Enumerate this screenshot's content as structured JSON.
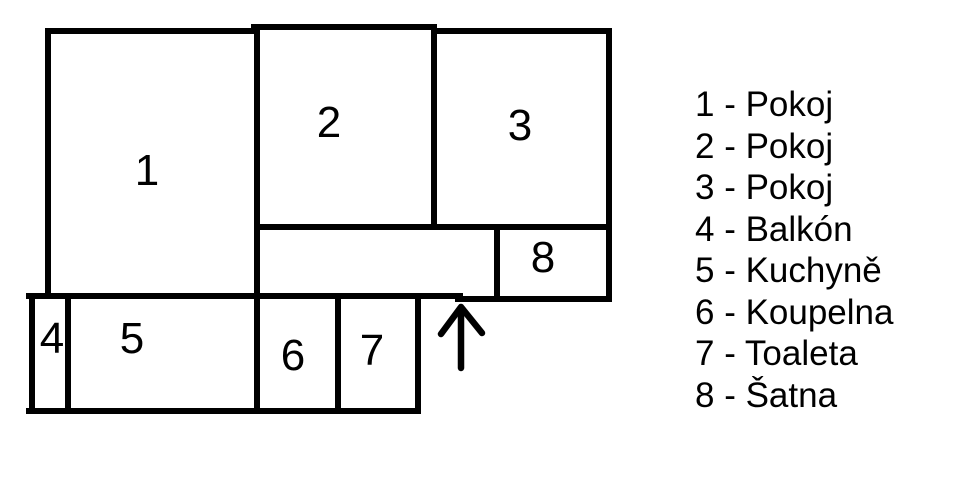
{
  "rooms": [
    {
      "number": "1",
      "name": "Pokoj"
    },
    {
      "number": "2",
      "name": "Pokoj"
    },
    {
      "number": "3",
      "name": "Pokoj"
    },
    {
      "number": "4",
      "name": "Balkón"
    },
    {
      "number": "5",
      "name": "Kuchyně"
    },
    {
      "number": "6",
      "name": "Koupelna"
    },
    {
      "number": "7",
      "name": "Toaleta"
    },
    {
      "number": "8",
      "name": "Šatna"
    }
  ],
  "legend": {
    "items": [
      "1 - Pokoj",
      "2 - Pokoj",
      "3 - Pokoj",
      "4 - Balkón",
      "5 - Kuchyně",
      "6 - Koupelna",
      "7 - Toaleta",
      "8 - Šatna"
    ]
  },
  "entrance": {
    "icon": "up-arrow"
  },
  "colors": {
    "background": "#ffffff",
    "wall": "#000000",
    "text": "#000000"
  }
}
